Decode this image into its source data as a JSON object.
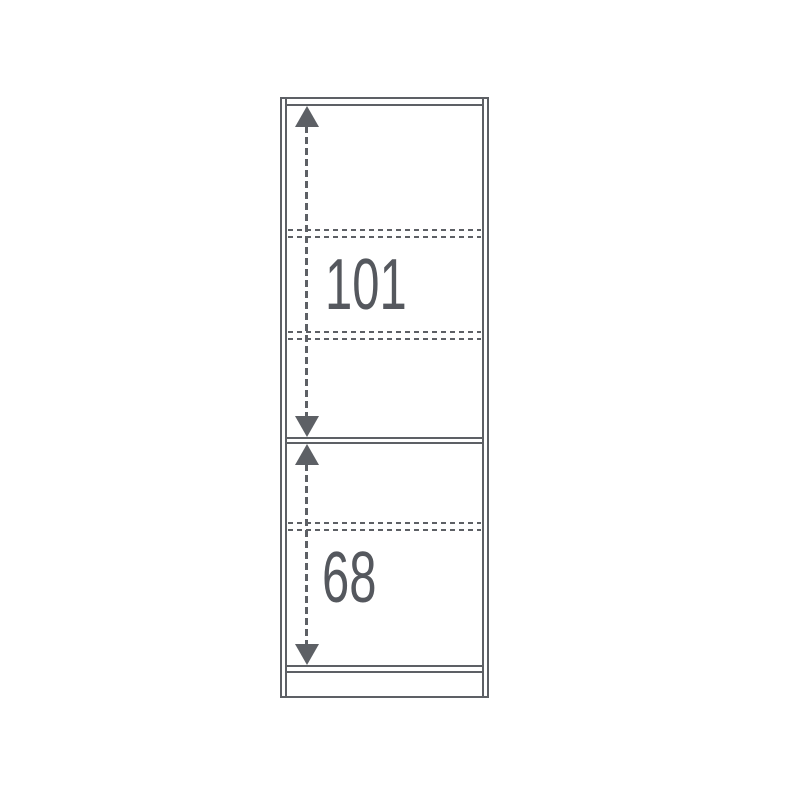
{
  "diagram": {
    "type": "cabinet-shelf-dimension-diagram",
    "background_color": "#ffffff",
    "line_color": "#5d6065",
    "label_color": "#55585e",
    "upper_section": {
      "dimension_label": "101"
    },
    "lower_section": {
      "dimension_label": "68"
    }
  }
}
